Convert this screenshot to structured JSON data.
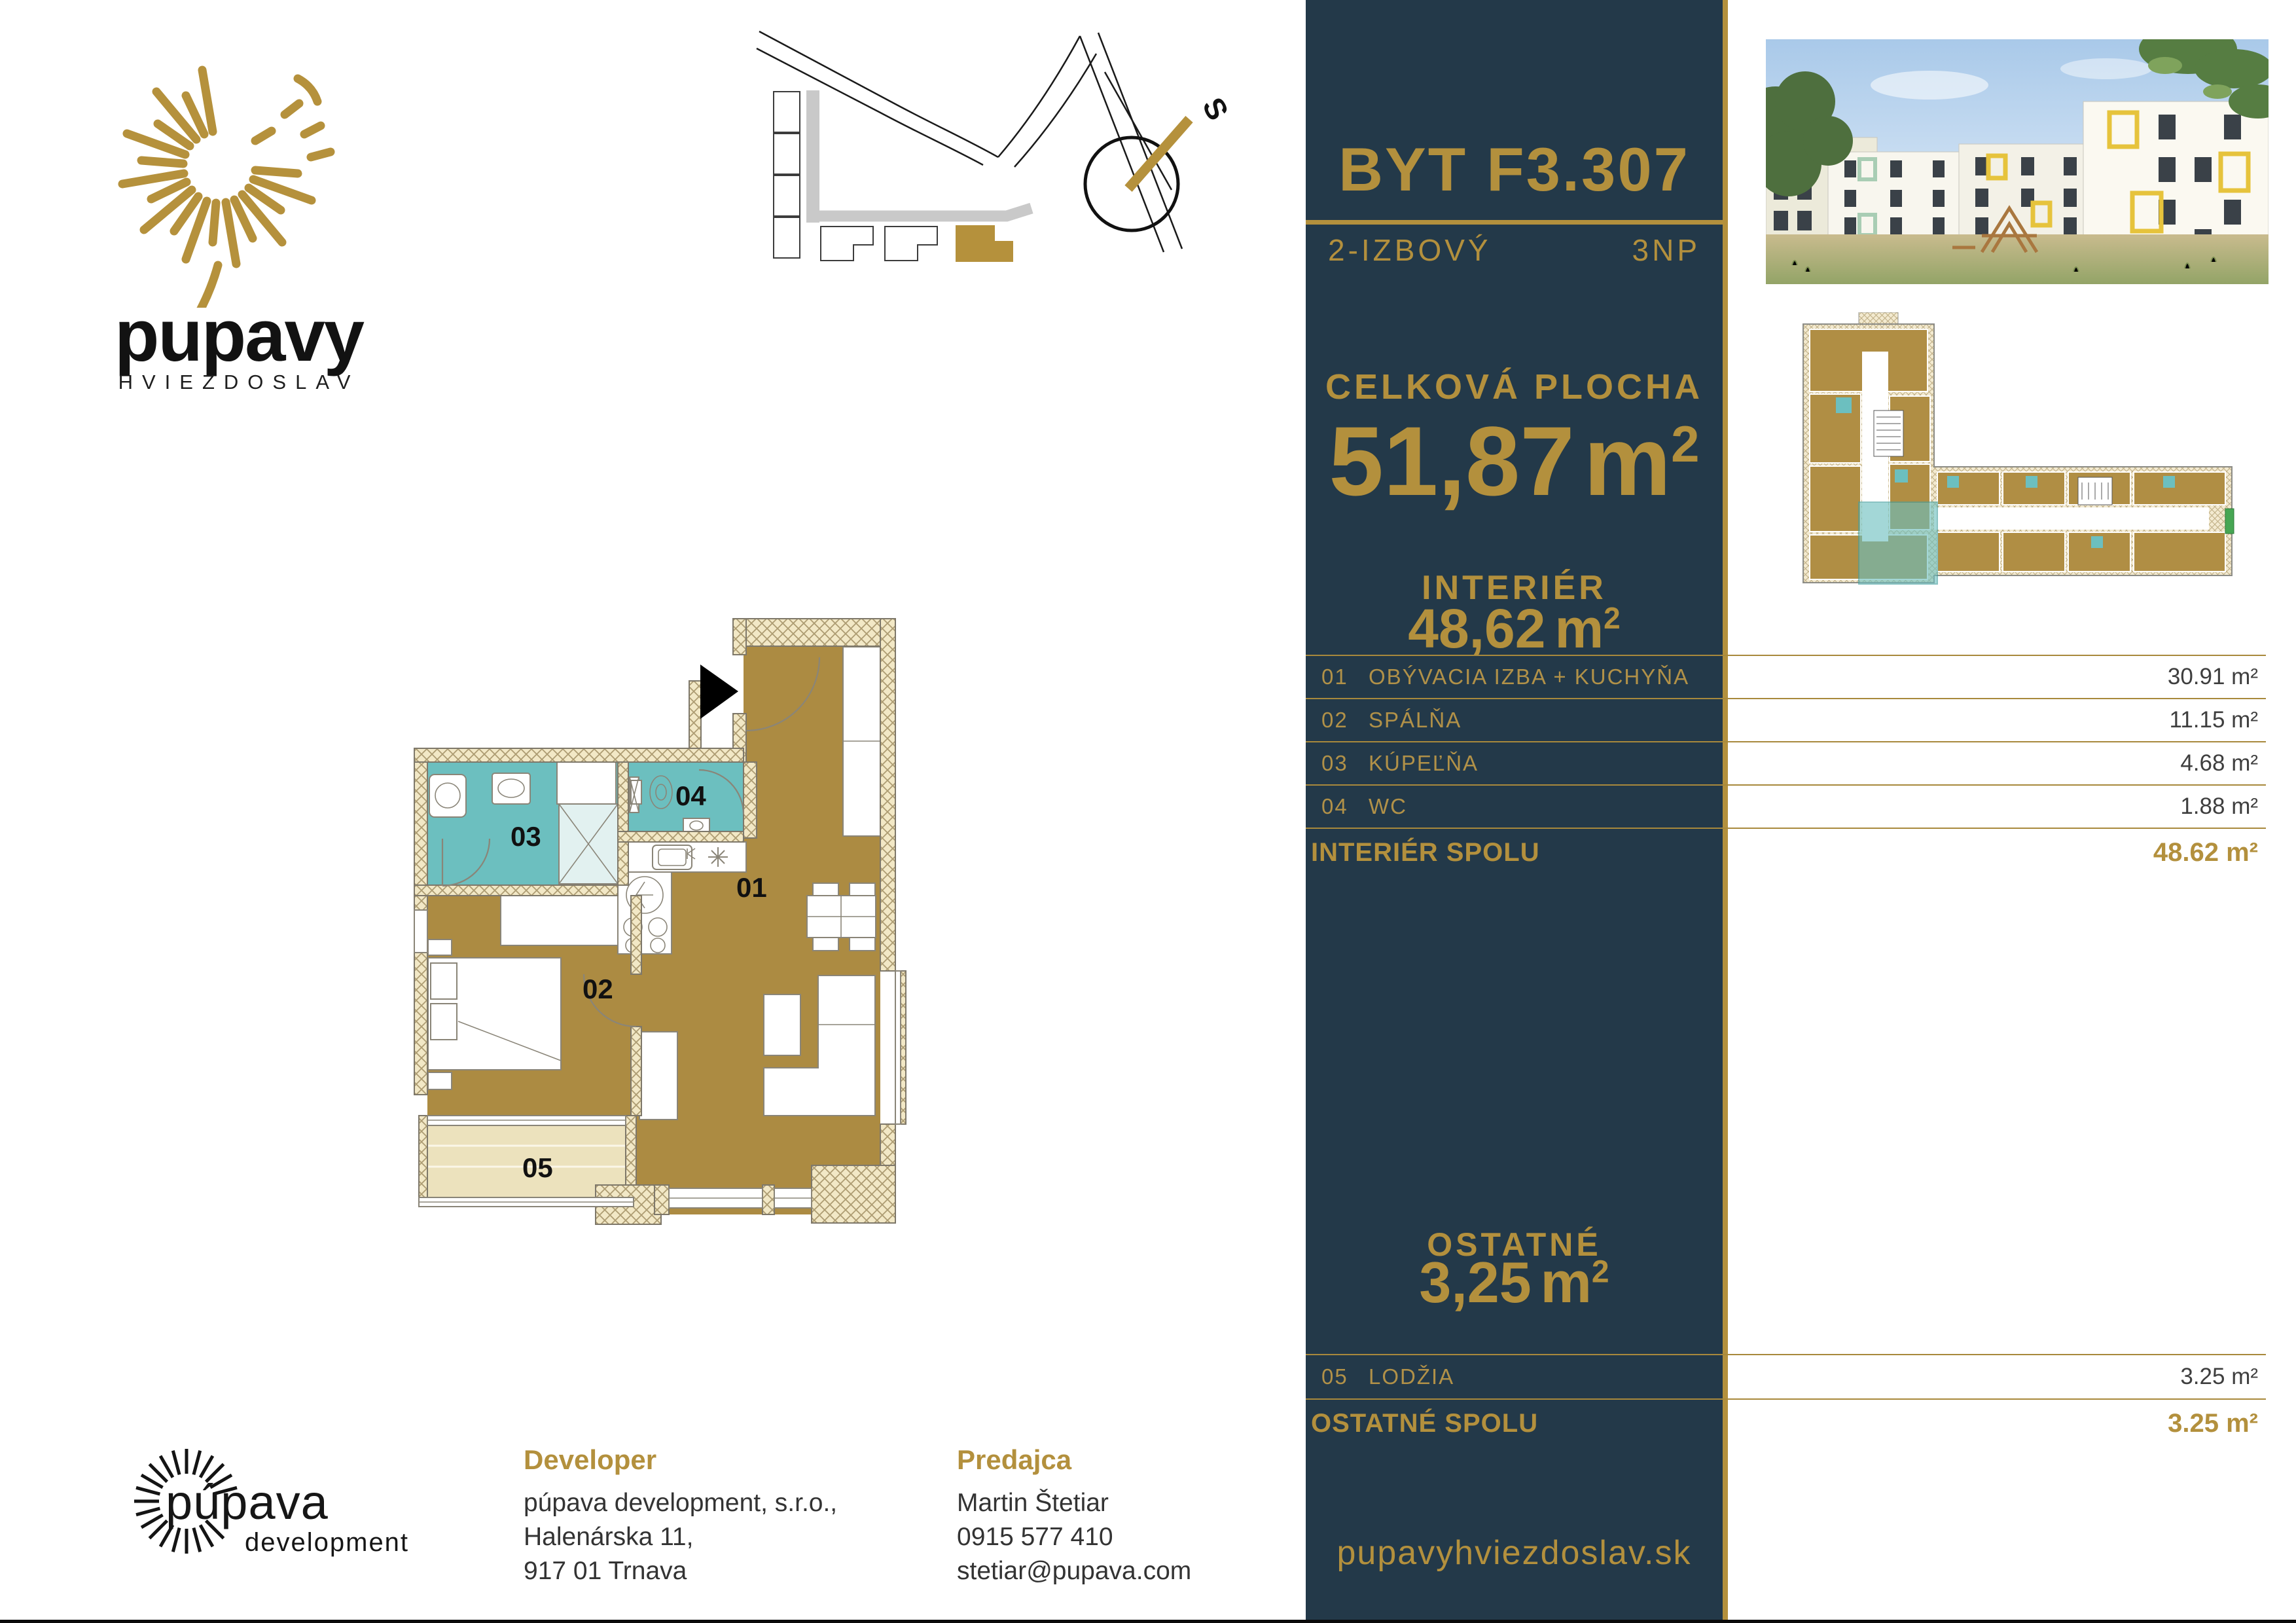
{
  "brand": {
    "name": "pupavy",
    "subtitle": "HVIEZDOSLAV"
  },
  "compass": {
    "label": "S"
  },
  "unit": {
    "title": "BYT F3.307",
    "type": "2-IZBOVÝ",
    "floor": "3NP",
    "total": {
      "label": "CELKOVÁ PLOCHA",
      "value": "51,87",
      "unit_base": "m",
      "unit_exp": "2"
    },
    "interior": {
      "label": "INTERIÉR",
      "value": "48,62",
      "unit_base": "m",
      "unit_exp": "2"
    },
    "rooms": [
      {
        "num": "01",
        "name": "OBÝVACIA IZBA + KUCHYŇA",
        "area": "30.91 m²"
      },
      {
        "num": "02",
        "name": "SPÁLŇA",
        "area": "11.15 m²"
      },
      {
        "num": "03",
        "name": "KÚPEĽŇA",
        "area": "4.68 m²"
      },
      {
        "num": "04",
        "name": "WC",
        "area": "1.88 m²"
      }
    ],
    "interior_total": {
      "label": "INTERIÉR SPOLU",
      "value": "48.62 m²"
    },
    "other": {
      "label": "OSTATNÉ",
      "value": "3,25",
      "unit_base": "m",
      "unit_exp": "2"
    },
    "other_rooms": [
      {
        "num": "05",
        "name": "LODŽIA",
        "area": "3.25 m²"
      }
    ],
    "other_total": {
      "label": "OSTATNÉ SPOLU",
      "value": "3.25 m²"
    }
  },
  "floorplan": {
    "labels": {
      "r1": "01",
      "r2": "02",
      "r3": "03",
      "r4": "04",
      "r5": "05"
    }
  },
  "website": "pupavyhviezdoslav.sk",
  "developer": {
    "heading": "Developer",
    "lines": [
      "púpava development, s.r.o.,",
      "Halenárska 11,",
      "917 01 Trnava"
    ]
  },
  "seller": {
    "heading": "Predajca",
    "lines": [
      "Martin Štetiar",
      "0915 577 410",
      "stetiar@pupava.com"
    ]
  },
  "dev_logo": {
    "line1": "púpava",
    "line2": "development"
  },
  "colors": {
    "navy": "#233949",
    "gold": "#b3903d",
    "floor_gold": "#ac8b42",
    "teal": "#6cbfbf",
    "wall": "#f2e8c6"
  }
}
